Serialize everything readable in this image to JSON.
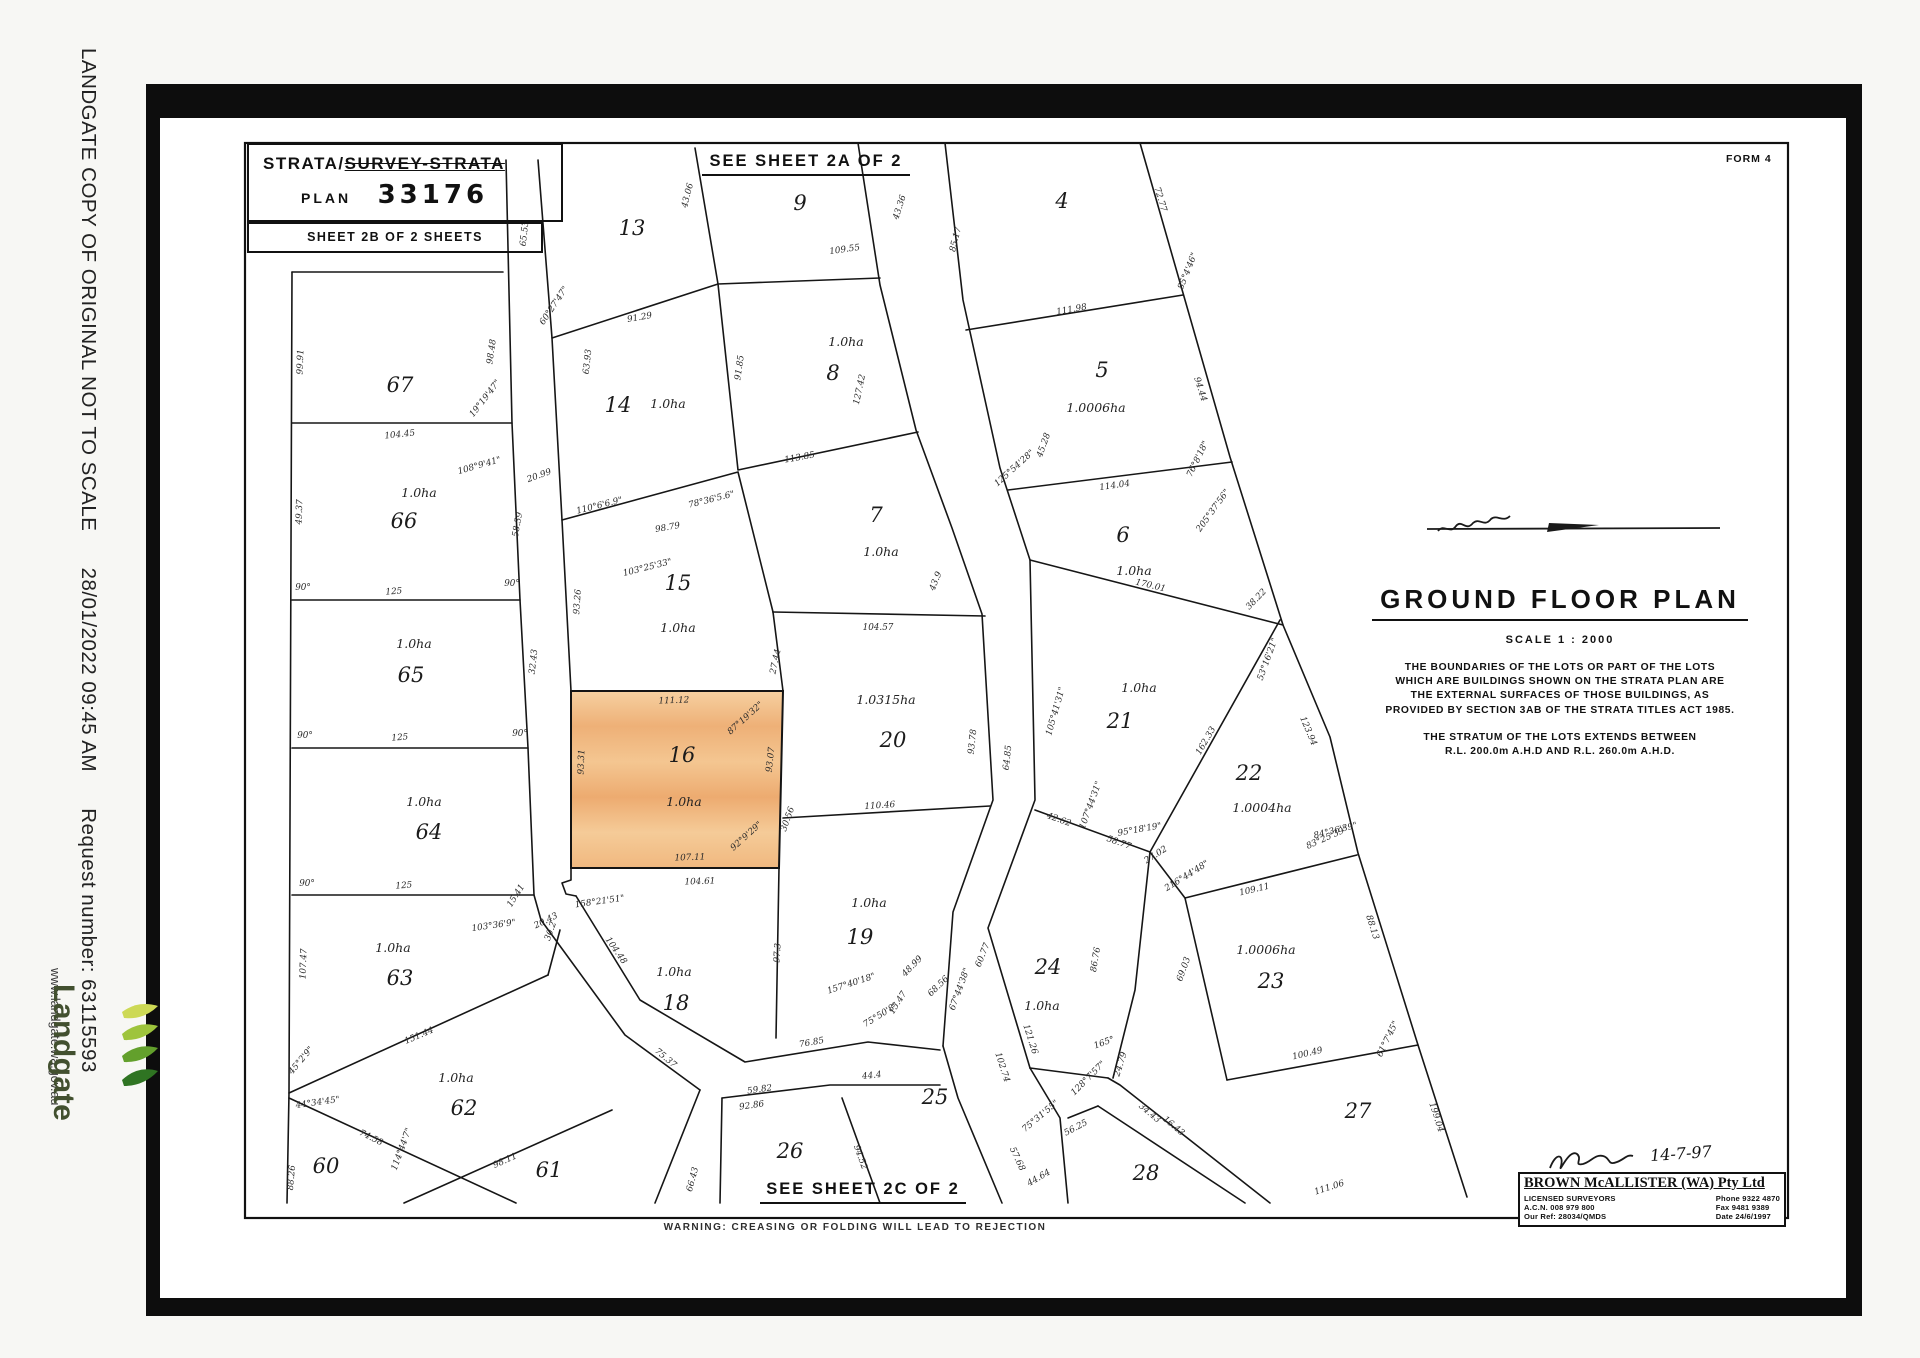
{
  "sidebar": {
    "notice": "LANDGATE COPY OF ORIGINAL NOT TO SCALE",
    "datetime": "28/01/2022 09:45 AM",
    "request": "Request number: 63115593",
    "brand": "Landgate",
    "website": "www.landgate.wa.gov.au"
  },
  "title_block": {
    "line1_prefix": "STRATA/",
    "line1_struck": "SURVEY-STRATA",
    "plan_label": "PLAN",
    "plan_number": "33176",
    "sheet_label": "SHEET 2B OF 2 SHEETS"
  },
  "form_label": "FORM 4",
  "refs": {
    "top": "SEE SHEET 2A OF 2",
    "bottom": "SEE SHEET 2C OF 2"
  },
  "warning": "WARNING: CREASING OR FOLDING WILL LEAD TO REJECTION",
  "notes": {
    "title": "GROUND FLOOR PLAN",
    "scale": "SCALE  1 : 2000",
    "para1": [
      "THE BOUNDARIES OF THE LOTS OR PART OF THE LOTS",
      "WHICH ARE BUILDINGS SHOWN ON THE STRATA PLAN ARE",
      "THE EXTERNAL SURFACES OF THOSE BUILDINGS, AS",
      "PROVIDED BY SECTION 3AB OF THE STRATA TITLES ACT 1985."
    ],
    "para2": [
      "THE STRATUM OF THE LOTS EXTENDS BETWEEN",
      "R.L. 200.0m A.H.D AND R.L. 260.0m A.H.D."
    ]
  },
  "surveyor": {
    "signature_date": "14-7-97",
    "firm": "BROWN McALLISTER (WA) Pty Ltd",
    "left": [
      "LICENSED SURVEYORS",
      "A.C.N. 008 979 800",
      "Our Ref: 28034/QMDS"
    ],
    "right": [
      "Phone 9322 4870",
      "Fax 9481 9389",
      "Date 24/6/1997"
    ]
  },
  "map": {
    "highlight_color": "#f2bd85",
    "lots": [
      {
        "n": "13",
        "x": 632,
        "y": 235
      },
      {
        "n": "9",
        "x": 800,
        "y": 210
      },
      {
        "n": "4",
        "x": 1062,
        "y": 208
      },
      {
        "n": "14",
        "x": 618,
        "y": 412,
        "a": "1.0ha",
        "ax": 668,
        "ay": 408
      },
      {
        "n": "8",
        "x": 833,
        "y": 380,
        "a": "1.0ha",
        "ax": 846,
        "ay": 346
      },
      {
        "n": "5",
        "x": 1102,
        "y": 377,
        "a": "1.0006ha",
        "ax": 1096,
        "ay": 412
      },
      {
        "n": "15",
        "x": 678,
        "y": 590,
        "a": "1.0ha",
        "ax": 678,
        "ay": 632
      },
      {
        "n": "7",
        "x": 876,
        "y": 522,
        "a": "1.0ha",
        "ax": 881,
        "ay": 556
      },
      {
        "n": "6",
        "x": 1123,
        "y": 542,
        "a": "1.0ha",
        "ax": 1134,
        "ay": 575
      },
      {
        "n": "16",
        "x": 682,
        "y": 762,
        "a": "1.0ha",
        "ax": 684,
        "ay": 806
      },
      {
        "n": "20",
        "x": 893,
        "y": 747,
        "a": "1.0315ha",
        "ax": 886,
        "ay": 704
      },
      {
        "n": "21",
        "x": 1120,
        "y": 728,
        "a": "1.0ha",
        "ax": 1139,
        "ay": 692
      },
      {
        "n": "22",
        "x": 1249,
        "y": 780,
        "a": "1.0004ha",
        "ax": 1262,
        "ay": 812
      },
      {
        "n": "19",
        "x": 860,
        "y": 944,
        "a": "1.0ha",
        "ax": 869,
        "ay": 907
      },
      {
        "n": "18",
        "x": 676,
        "y": 1010,
        "a": "1.0ha",
        "ax": 674,
        "ay": 976
      },
      {
        "n": "24",
        "x": 1048,
        "y": 974,
        "a": "1.0ha",
        "ax": 1042,
        "ay": 1010
      },
      {
        "n": "23",
        "x": 1271,
        "y": 988,
        "a": "1.0006ha",
        "ax": 1266,
        "ay": 954
      },
      {
        "n": "25",
        "x": 935,
        "y": 1104
      },
      {
        "n": "26",
        "x": 790,
        "y": 1158
      },
      {
        "n": "27",
        "x": 1358,
        "y": 1118
      },
      {
        "n": "28",
        "x": 1146,
        "y": 1180
      },
      {
        "n": "67",
        "x": 400,
        "y": 392
      },
      {
        "n": "66",
        "x": 404,
        "y": 528,
        "a": "1.0ha",
        "ax": 419,
        "ay": 497
      },
      {
        "n": "65",
        "x": 411,
        "y": 682,
        "a": "1.0ha",
        "ax": 414,
        "ay": 648
      },
      {
        "n": "64",
        "x": 429,
        "y": 839,
        "a": "1.0ha",
        "ax": 424,
        "ay": 806
      },
      {
        "n": "63",
        "x": 400,
        "y": 985,
        "a": "1.0ha",
        "ax": 393,
        "ay": 952
      },
      {
        "n": "62",
        "x": 464,
        "y": 1115,
        "a": "1.0ha",
        "ax": 456,
        "ay": 1082
      },
      {
        "n": "60",
        "x": 326,
        "y": 1173
      },
      {
        "n": "61",
        "x": 549,
        "y": 1177
      }
    ],
    "dims": [
      [
        "99.91",
        303,
        362,
        -88
      ],
      [
        "98.48",
        494,
        352,
        -82
      ],
      [
        "19°19'47\"",
        487,
        400,
        -52
      ],
      [
        "104.45",
        400,
        437,
        -6
      ],
      [
        "49.37",
        302,
        512,
        -88
      ],
      [
        "58.39",
        520,
        525,
        -80
      ],
      [
        "108°9'41\"",
        480,
        468,
        -16
      ],
      [
        "20.99",
        540,
        478,
        -20
      ],
      [
        "125",
        394,
        594,
        -4
      ],
      [
        "90°",
        303,
        590,
        0
      ],
      [
        "90°",
        512,
        586,
        0
      ],
      [
        "125",
        400,
        740,
        -4
      ],
      [
        "90°",
        305,
        738,
        0
      ],
      [
        "90°",
        520,
        736,
        0
      ],
      [
        "125",
        404,
        888,
        -4
      ],
      [
        "90°",
        307,
        886,
        0
      ],
      [
        "107.47",
        306,
        964,
        -88
      ],
      [
        "151.44",
        420,
        1038,
        -23
      ],
      [
        "74.58",
        370,
        1140,
        26
      ],
      [
        "114°44'7\"",
        404,
        1150,
        -70
      ],
      [
        "44°34'45\"",
        318,
        1105,
        -8
      ],
      [
        "45°2'9\"",
        303,
        1062,
        -50
      ],
      [
        "88.26",
        294,
        1178,
        -85
      ],
      [
        "98.11",
        506,
        1163,
        -24
      ],
      [
        "66.43",
        695,
        1180,
        -75
      ],
      [
        "65.53",
        527,
        234,
        -84
      ],
      [
        "32.43",
        536,
        662,
        -84
      ],
      [
        "15.41",
        518,
        897,
        -58
      ],
      [
        "20.43",
        547,
        923,
        -26
      ],
      [
        "60°27'47\"",
        556,
        307,
        -56
      ],
      [
        "63.93",
        590,
        362,
        -84
      ],
      [
        "43.06",
        690,
        196,
        -76
      ],
      [
        "91.29",
        640,
        320,
        -10
      ],
      [
        "109.55",
        845,
        252,
        -8
      ],
      [
        "43.36",
        902,
        208,
        -72
      ],
      [
        "85.17",
        958,
        240,
        -76
      ],
      [
        "72.77",
        1158,
        200,
        73
      ],
      [
        "111.98",
        1072,
        312,
        -10
      ],
      [
        "85°4'46\"",
        1190,
        272,
        -68
      ],
      [
        "91.85",
        742,
        368,
        -82
      ],
      [
        "127.42",
        862,
        390,
        -78
      ],
      [
        "98.79",
        668,
        530,
        -10
      ],
      [
        "110°6'6.9\"",
        600,
        508,
        -14
      ],
      [
        "78°36'5.6\"",
        712,
        502,
        -14
      ],
      [
        "113.85",
        800,
        460,
        -10
      ],
      [
        "45.28",
        1046,
        446,
        -70
      ],
      [
        "125°54'28\"",
        1016,
        470,
        -42
      ],
      [
        "114.04",
        1115,
        488,
        -8
      ],
      [
        "94.44",
        1198,
        390,
        72
      ],
      [
        "76°8'18\"",
        1200,
        460,
        -64
      ],
      [
        "205°37'56\"",
        1215,
        512,
        -54
      ],
      [
        "93.26",
        580,
        602,
        -86
      ],
      [
        "27.44",
        778,
        662,
        -78
      ],
      [
        "103°25'33\"",
        648,
        570,
        -14
      ],
      [
        "104.57",
        878,
        630,
        0
      ],
      [
        "43.9",
        938,
        582,
        -68
      ],
      [
        "170.01",
        1150,
        588,
        13
      ],
      [
        "105°41'31\"",
        1058,
        712,
        -74
      ],
      [
        "93.78",
        975,
        742,
        -84
      ],
      [
        "64.85",
        1010,
        758,
        -84
      ],
      [
        "162.33",
        1208,
        742,
        -60
      ],
      [
        "123.94",
        1306,
        732,
        67
      ],
      [
        "53°16'21\"",
        1270,
        660,
        -70
      ],
      [
        "38.22",
        1258,
        601,
        -46
      ],
      [
        "111.12",
        674,
        703,
        -2
      ],
      [
        "93.31",
        584,
        762,
        -88
      ],
      [
        "93.07",
        773,
        760,
        -84
      ],
      [
        "87°19'32\"",
        747,
        720,
        -42
      ],
      [
        "107.11",
        690,
        860,
        -2
      ],
      [
        "104.61",
        700,
        884,
        -2
      ],
      [
        "92°9'29\"",
        748,
        838,
        -42
      ],
      [
        "30.56",
        790,
        820,
        -70
      ],
      [
        "158°21'51\"",
        600,
        904,
        -8
      ],
      [
        "103°36'9\"",
        494,
        928,
        -8
      ],
      [
        "30.2",
        553,
        932,
        -70
      ],
      [
        "110.46",
        880,
        808,
        -4
      ],
      [
        "58.77",
        1118,
        845,
        20
      ],
      [
        "42.62",
        1058,
        822,
        20
      ],
      [
        "107°44'31\"",
        1093,
        806,
        -70
      ],
      [
        "95°18'19\"",
        1140,
        832,
        -10
      ],
      [
        "27.02",
        1157,
        857,
        -32
      ],
      [
        "216°44'48\"",
        1188,
        878,
        -32
      ],
      [
        "84°36'39\"",
        1336,
        833,
        -14
      ],
      [
        "104.48",
        614,
        952,
        55
      ],
      [
        "75.37",
        664,
        1060,
        40
      ],
      [
        "59.82",
        760,
        1092,
        -8
      ],
      [
        "97.3",
        780,
        953,
        -86
      ],
      [
        "76.85",
        812,
        1045,
        -10
      ],
      [
        "157°40'18\"",
        852,
        986,
        -18
      ],
      [
        "44.4",
        872,
        1078,
        -6
      ],
      [
        "75°50'8\"",
        882,
        1017,
        -32
      ],
      [
        "15.47",
        900,
        1004,
        -58
      ],
      [
        "48.99",
        914,
        968,
        -46
      ],
      [
        "68.56",
        940,
        988,
        -44
      ],
      [
        "67°44'38\"",
        962,
        990,
        -70
      ],
      [
        "92.86",
        752,
        1108,
        -8
      ],
      [
        "94.52",
        858,
        1158,
        70
      ],
      [
        "102.74",
        1000,
        1068,
        72
      ],
      [
        "75°31'55\"",
        1042,
        1118,
        -40
      ],
      [
        "56.25",
        1077,
        1130,
        -28
      ],
      [
        "57.68",
        1015,
        1160,
        65
      ],
      [
        "44.64",
        1040,
        1180,
        -30
      ],
      [
        "24.79",
        1123,
        1065,
        -72
      ],
      [
        "165°",
        1105,
        1045,
        -20
      ],
      [
        "128°7'57\"",
        1090,
        1080,
        -45
      ],
      [
        "86.76",
        1098,
        960,
        -80
      ],
      [
        "121.26",
        1028,
        1040,
        72
      ],
      [
        "60.77",
        985,
        956,
        -68
      ],
      [
        "34.43",
        1148,
        1115,
        40
      ],
      [
        "16.43",
        1172,
        1128,
        40
      ],
      [
        "109.11",
        1255,
        892,
        -13
      ],
      [
        "100.49",
        1308,
        1056,
        -13
      ],
      [
        "69.03",
        1186,
        970,
        -70
      ],
      [
        "83°25'39\"",
        1328,
        840,
        -24
      ],
      [
        "88.13",
        1370,
        928,
        72
      ],
      [
        "61°7'45\"",
        1390,
        1040,
        -64
      ],
      [
        "199.04",
        1434,
        1118,
        72
      ],
      [
        "111.06",
        1330,
        1190,
        -18
      ]
    ]
  }
}
